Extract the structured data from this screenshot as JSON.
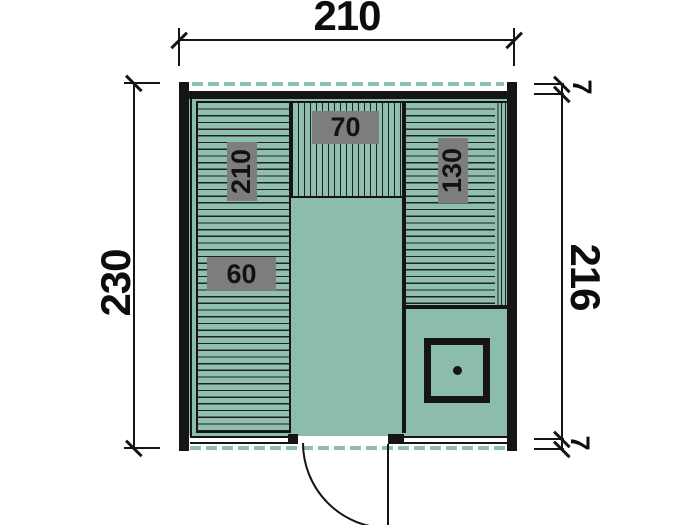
{
  "drawing": {
    "dimensions": {
      "top_width": "210",
      "left_height": "230",
      "right_inner_height": "216",
      "top_right_offset": "7",
      "bottom_right_offset": "7"
    },
    "labels": {
      "left_bench_length": "210",
      "left_bench_width": "60",
      "top_bench_width": "70",
      "right_bench_length": "130"
    },
    "colors": {
      "floor": "#8CBCAB",
      "plank_line": "#20201E",
      "overhang_dash": "#8FBFAE",
      "label_background": "#7D7D7D",
      "wall": "#151515"
    }
  }
}
